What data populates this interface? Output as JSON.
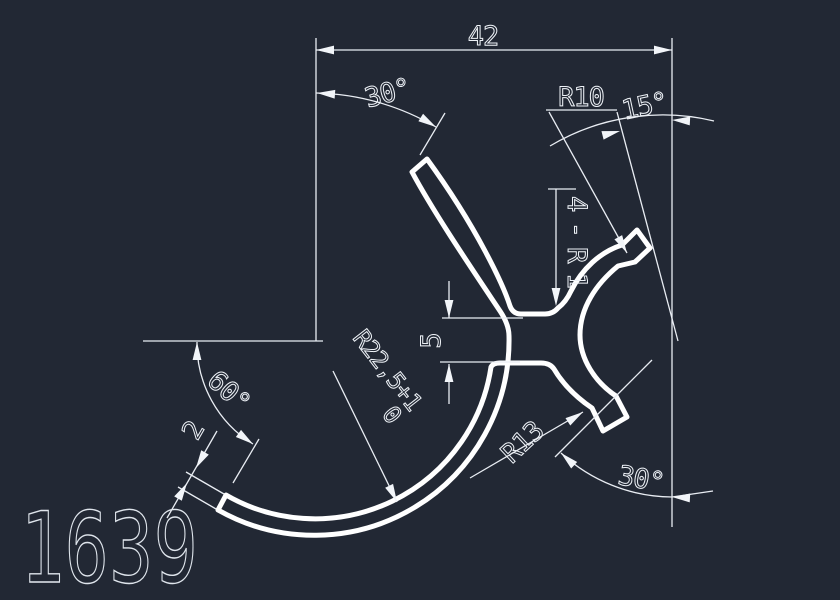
{
  "canvas": {
    "background_color": "#222834",
    "line_color": "#ffffff",
    "width": 840,
    "height": 600
  },
  "title_block": {
    "part_number": "1639"
  },
  "dimensions": {
    "overall_width": "42",
    "top_left_angle": "30°",
    "top_right_radius": "R10",
    "top_right_angle": "15°",
    "fillet_note": "4-R1",
    "web_height": "5",
    "main_radius_value": "R22,5+1",
    "main_radius_tolerance_low": "0",
    "bottom_left_angle": "60°",
    "wall_thickness": "2",
    "socket_radius": "R13",
    "bottom_right_angle": "30°"
  }
}
